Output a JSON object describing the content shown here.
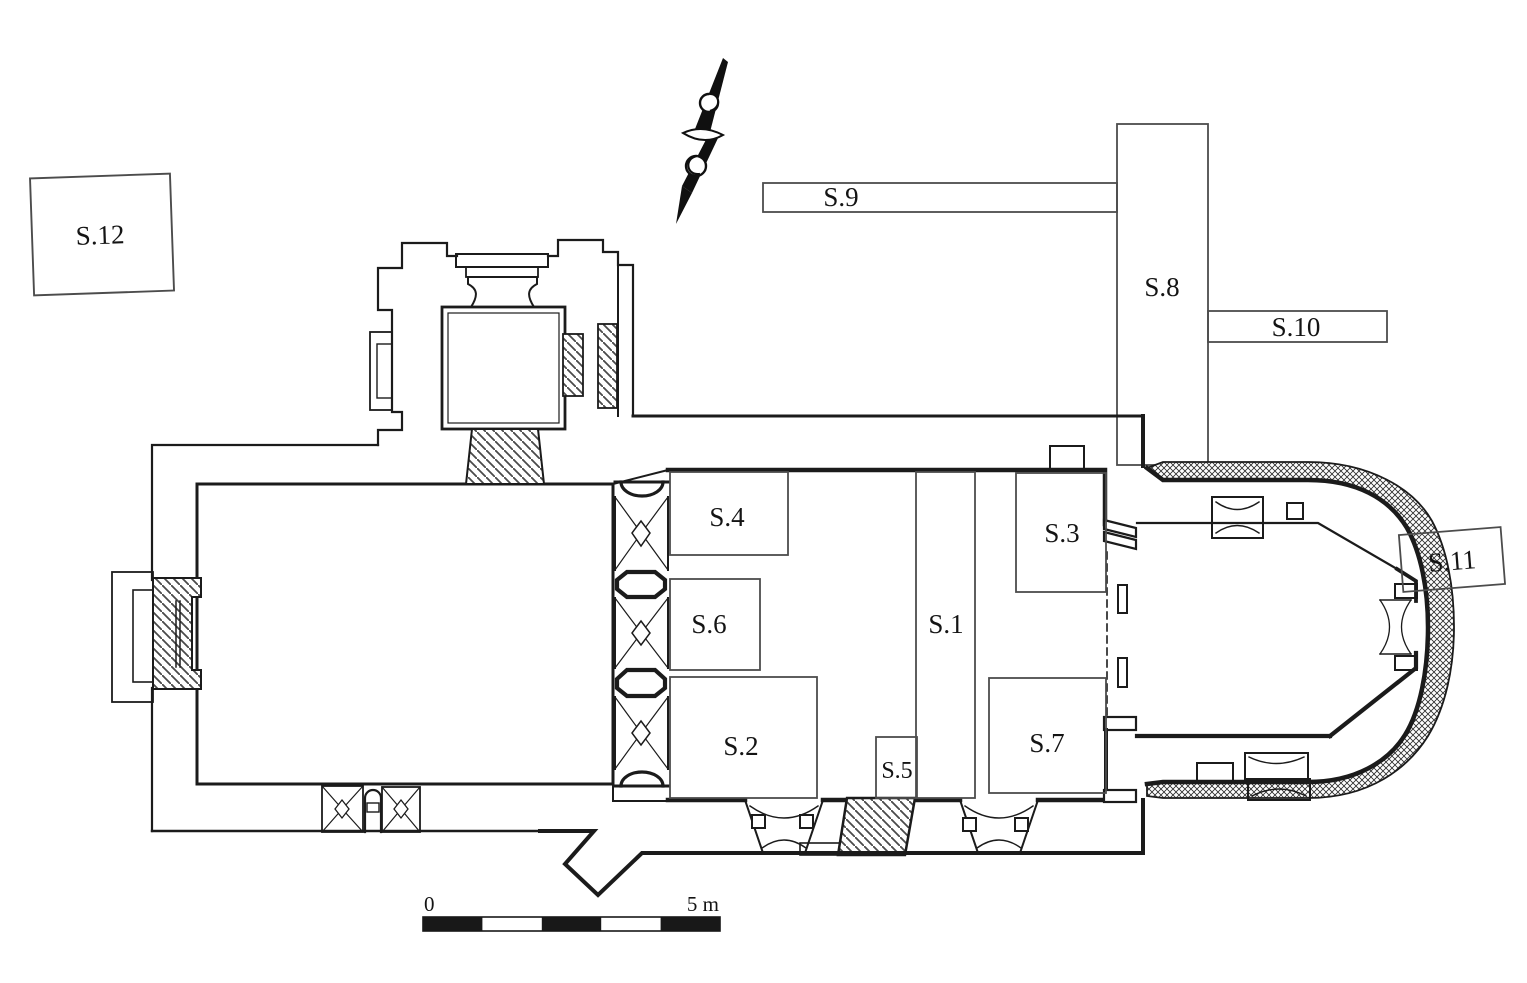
{
  "figure": {
    "kind": "archaeological site plan",
    "subject": "church ground plan with numbered excavation sondages",
    "paper_color": "#ffffff",
    "ink_color": "#1b1b1b",
    "trench_line_color": "#4c4c4c"
  },
  "labels": {
    "s1": "S.1",
    "s2": "S.2",
    "s3": "S.3",
    "s4": "S.4",
    "s5": "S.5",
    "s6": "S.6",
    "s7": "S.7",
    "s8": "S.8",
    "s9": "S.9",
    "s10": "S.10",
    "s11": "S.11",
    "s12": "S.12"
  },
  "scale_bar": {
    "zero_label": "0",
    "end_label": "5 m",
    "segment_count": 5,
    "bar_color": "#181818"
  },
  "icons": {
    "north_arrow": "north-arrow"
  }
}
